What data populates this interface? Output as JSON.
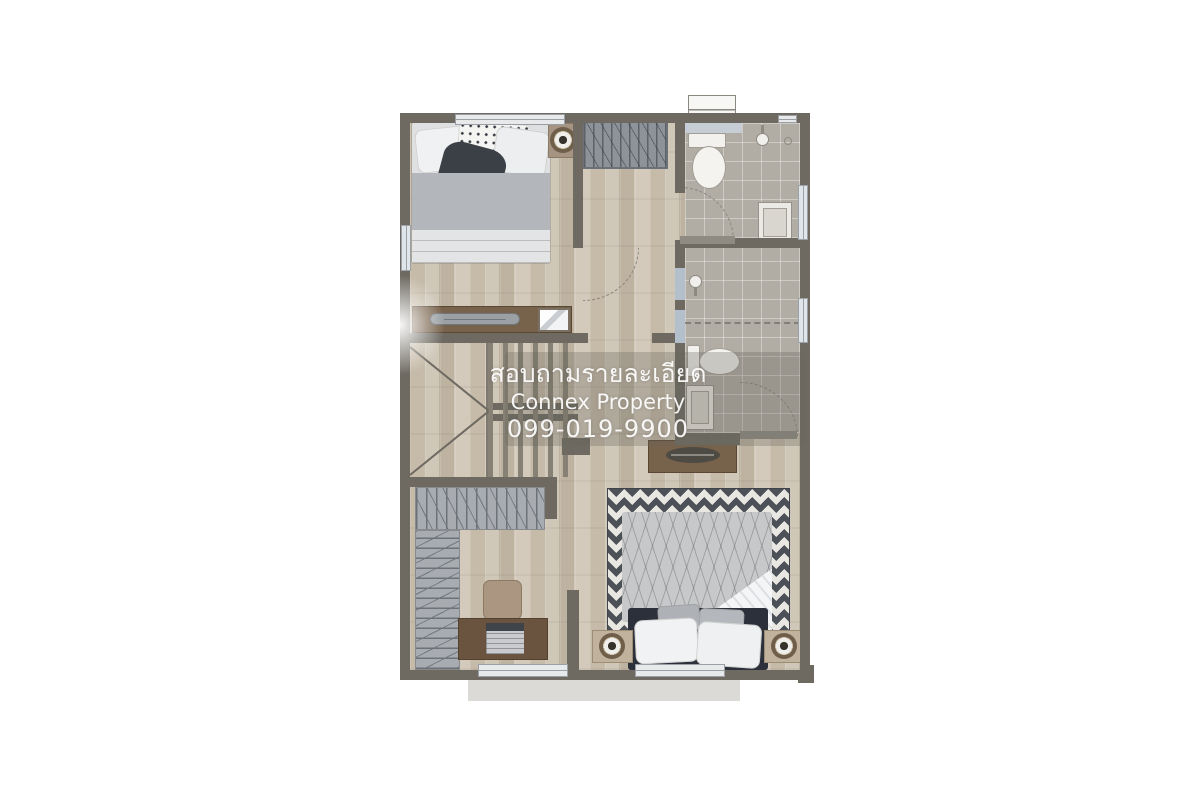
{
  "watermark": {
    "line1": "สอบถามรายละเอียด",
    "line2": "Connex Property",
    "line3": "099-019-9900",
    "text_color": "#ffffff"
  },
  "palette": {
    "page_background": "#ffffff",
    "exterior_wall": "#6e6a62",
    "wood_floor": "#c9bfb0",
    "bathroom_tile": "#b2ada4",
    "closet_mat": "#a8acb1",
    "wardrobe_gray": "#8e9399",
    "rug_dark": "#4c5057",
    "rug_light": "#e9e7e2",
    "furniture_wood": "#77624b",
    "headboard_dark": "#2b303a",
    "duvet_gray": "#b3b6ba",
    "fixture_white": "#f2f1ee"
  }
}
